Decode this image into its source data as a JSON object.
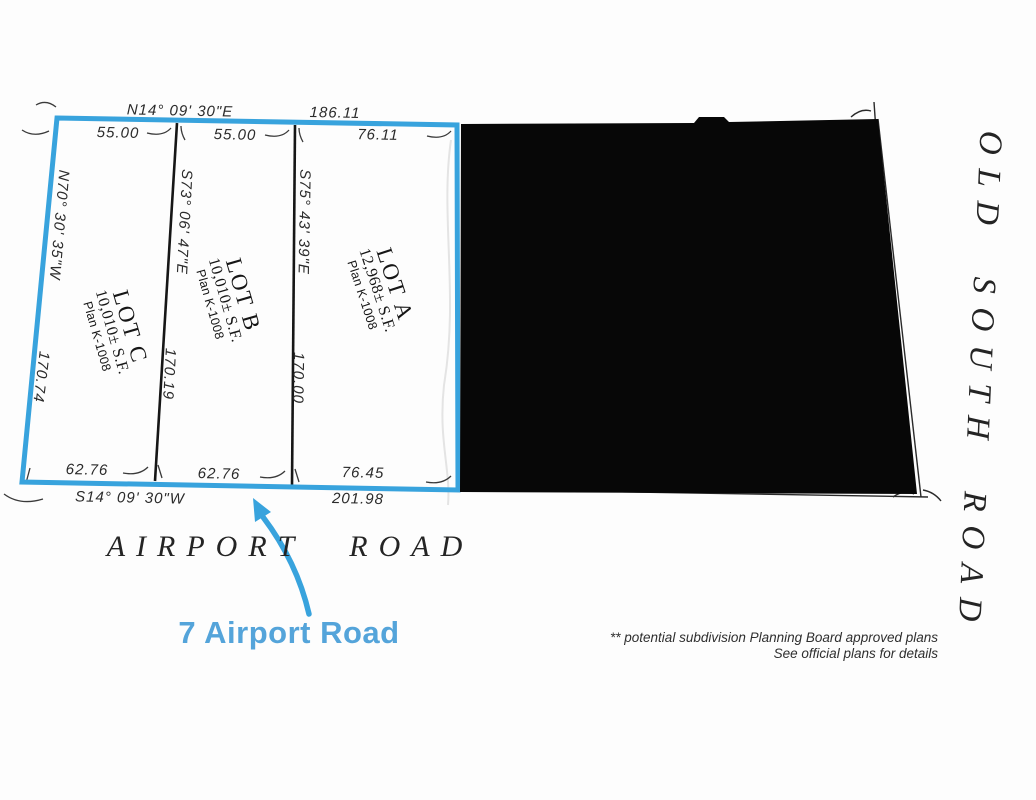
{
  "colors": {
    "accent_blue": "#38a3dd",
    "label_blue": "#54a4da",
    "ink": "#1f1f1f",
    "redaction": "#070707",
    "bg": "#fdfdfd"
  },
  "boundary": {
    "top_bearing": "N14° 09' 30\"E",
    "top_total": "186.11",
    "top_segments": [
      "55.00",
      "55.00",
      "76.11"
    ],
    "left_bearing": "N70° 30' 35\"W",
    "left_length": "170.74",
    "bottom_segments": [
      "62.76",
      "62.76",
      "76.45"
    ],
    "bottom_bearing": "S14° 09' 30\"W",
    "bottom_total": "201.98"
  },
  "lots": [
    {
      "name": "LOT C",
      "area": "10,010± S.F.",
      "plan": "Plan K-1008"
    },
    {
      "name": "LOT B",
      "area": "10,010± S.F.",
      "plan": "Plan K-1008"
    },
    {
      "name": "LOT A",
      "area": "12,968± S.F.",
      "plan": "Plan K-1008"
    }
  ],
  "dividers": [
    {
      "bearing": "S73° 06' 47\"E",
      "length": "170.19"
    },
    {
      "bearing": "S75° 43' 39\"E",
      "length": "170.00"
    }
  ],
  "roads": {
    "bottom": "AIRPORT ROAD",
    "right": "OLD SOUTH ROAD"
  },
  "annotation": {
    "label": "7 Airport Road"
  },
  "disclaimer": {
    "line1": "** potential subdivision Planning Board approved plans",
    "line2": "See official plans for details"
  }
}
